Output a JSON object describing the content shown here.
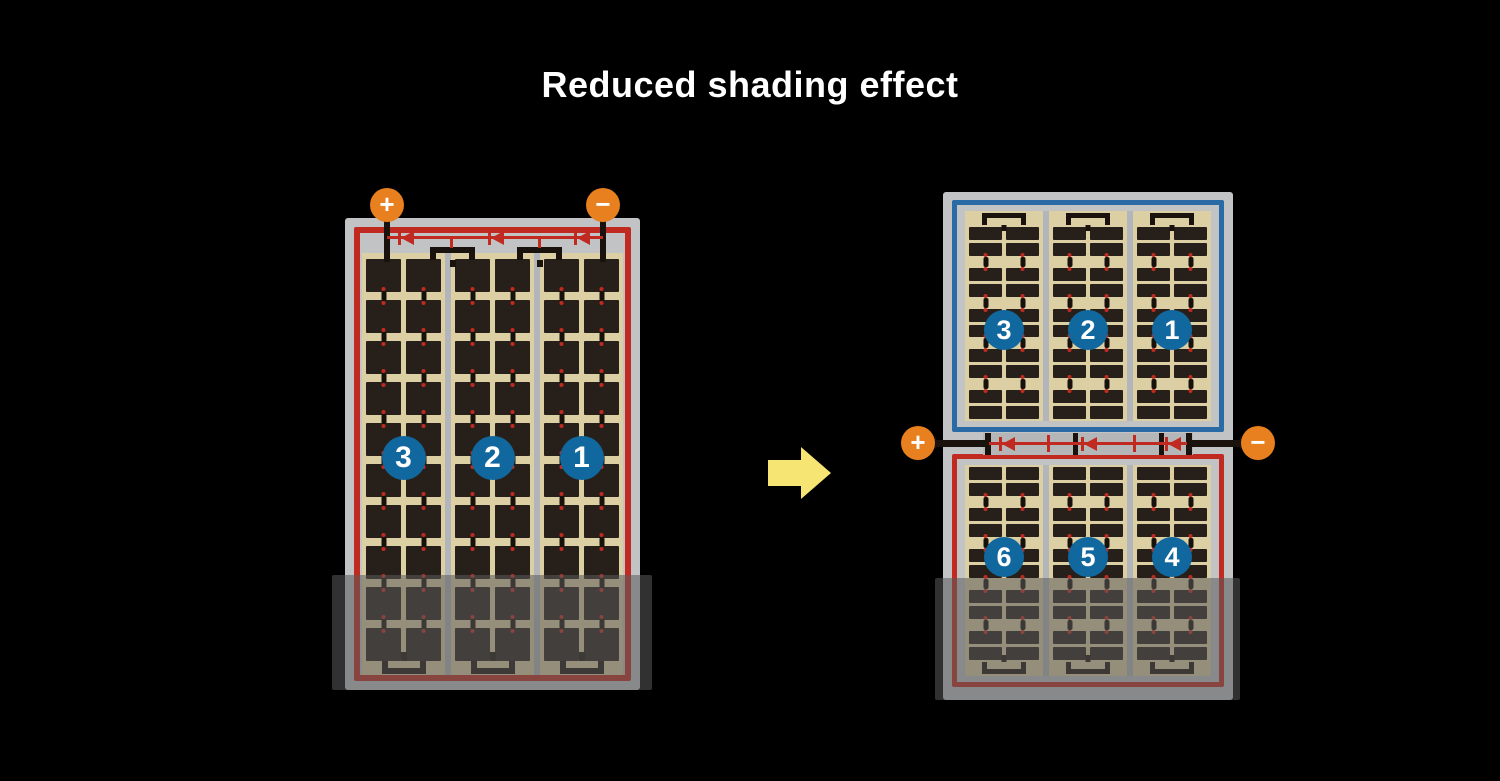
{
  "title": "Reduced shading effect",
  "before_panel": {
    "strings": [
      {
        "label": "3"
      },
      {
        "label": "2"
      },
      {
        "label": "1"
      }
    ],
    "terminals": {
      "positive": "+",
      "negative": "−"
    },
    "bypass_diodes": 3,
    "cell_rows": 10,
    "columns_per_string": 2,
    "shaded_bottom": true
  },
  "after_panel": {
    "top_half": {
      "strings": [
        {
          "label": "3"
        },
        {
          "label": "2"
        },
        {
          "label": "1"
        }
      ]
    },
    "bottom_half": {
      "strings": [
        {
          "label": "6"
        },
        {
          "label": "5"
        },
        {
          "label": "4"
        }
      ]
    },
    "terminals": {
      "positive": "+",
      "negative": "−"
    },
    "bypass_diodes": 3,
    "cell_pair_rows_per_half": 5,
    "columns_per_string": 2,
    "shaded_bottom": true
  },
  "colors": {
    "background": "#000000",
    "title_text": "#ffffff",
    "panel_frame_gray": "#c2c3c5",
    "cell_background_tan": "#dccfa3",
    "cell_dark": "#27201a",
    "string_border_red": "#c12a20",
    "string_border_blue": "#2a6ba6",
    "string_badge_blue": "#11689f",
    "terminal_orange": "#e8801f",
    "wire_black": "#1a130d",
    "arrow_yellow": "#f7e573"
  }
}
